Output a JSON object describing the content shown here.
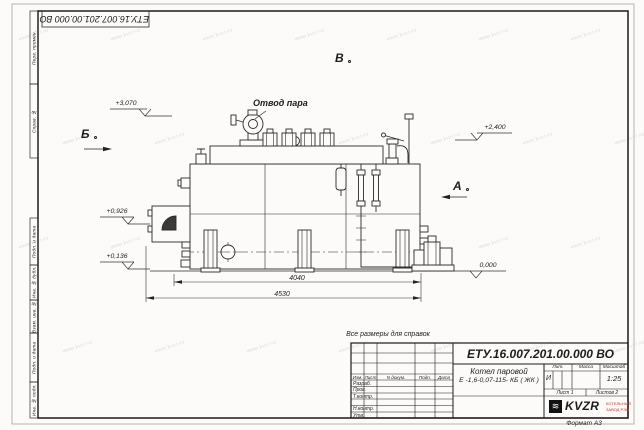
{
  "watermark": {
    "text": "www.kvzr.ru"
  },
  "corner_stamp": {
    "doc_number": "ЕТУ.16.007.201.00.000  ВО"
  },
  "margins": {
    "top": [
      "Перв. примен.",
      "Справ. №"
    ],
    "bottom": [
      "Подп. и дата",
      "Инв. № дубл.",
      "Взам. инв. №",
      "Подп. и дата",
      "Инв. № подл."
    ]
  },
  "note": "Все размеры для справок",
  "format_label": "Формат А3",
  "drawing": {
    "steam_outlet_label": "Отвод пара",
    "views": {
      "b": "Б",
      "a": "А",
      "v": "В"
    },
    "elevations": {
      "top_left": "+3,070",
      "top_right": "+2,400",
      "mid_left": "+0,926",
      "low_left": "+0,136",
      "ground": "0,000"
    },
    "dims": {
      "inner": "4040",
      "overall": "4530"
    }
  },
  "title_block": {
    "doc_number": "ЕТУ.16.007.201.00.000  ВО",
    "product_line1": "Котел паровой",
    "product_line2": "Е -1,6-0,07-115- КБ ( ЖК )",
    "header": [
      "Изм.",
      "Лист",
      "N докум.",
      "Подп.",
      "Дата"
    ],
    "rows": [
      "Разраб.",
      "Пров.",
      "Т.контр.",
      "Н.контр.",
      "Утв."
    ],
    "lit_header": [
      "Лит.",
      "Масса",
      "Масштаб"
    ],
    "lit_value": "И",
    "scale_value": "1:25",
    "sheet_info": [
      "Лист 1",
      "Листов 2"
    ],
    "logo": {
      "glyph": "≋",
      "text": "KVZR",
      "company_line1": "КОТЕЛЬНЫЙ",
      "company_line2": "ЗАВОД РЭП"
    }
  }
}
